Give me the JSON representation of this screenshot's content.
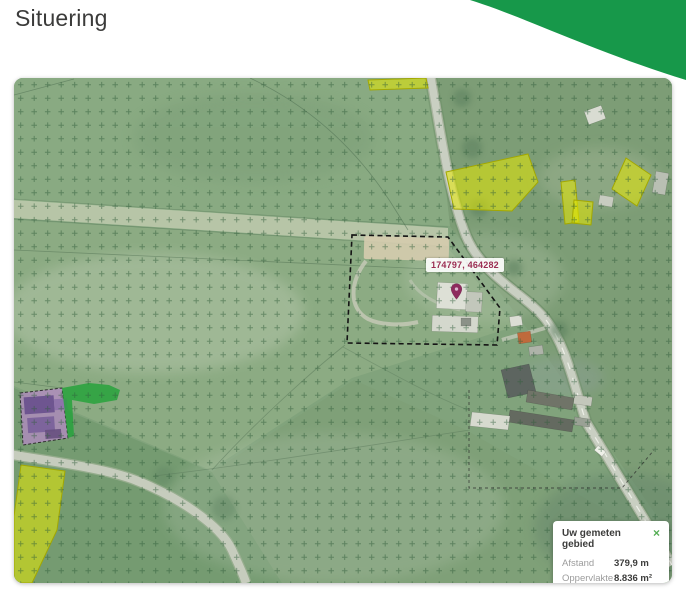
{
  "page": {
    "title": "Situering"
  },
  "theme": {
    "header_green": "#17984a",
    "pin_color": "#8e2a5d",
    "coord_text_color": "#9b2d52",
    "close_icon_color": "#53ad53",
    "parcel_yellow": "#e6ea00",
    "parcel_purple": "#b18bc1",
    "parcel_green": "#27a23c"
  },
  "map": {
    "coordinate_label": "174797, 464282",
    "pin_icon": "map-pin",
    "tooltip": {
      "title": "Uw gemeten gebied",
      "close_label": "×",
      "rows": [
        {
          "label": "Afstand",
          "value": "379,9 m"
        },
        {
          "label": "Oppervlakte",
          "value": "8.836 m²"
        }
      ]
    }
  }
}
